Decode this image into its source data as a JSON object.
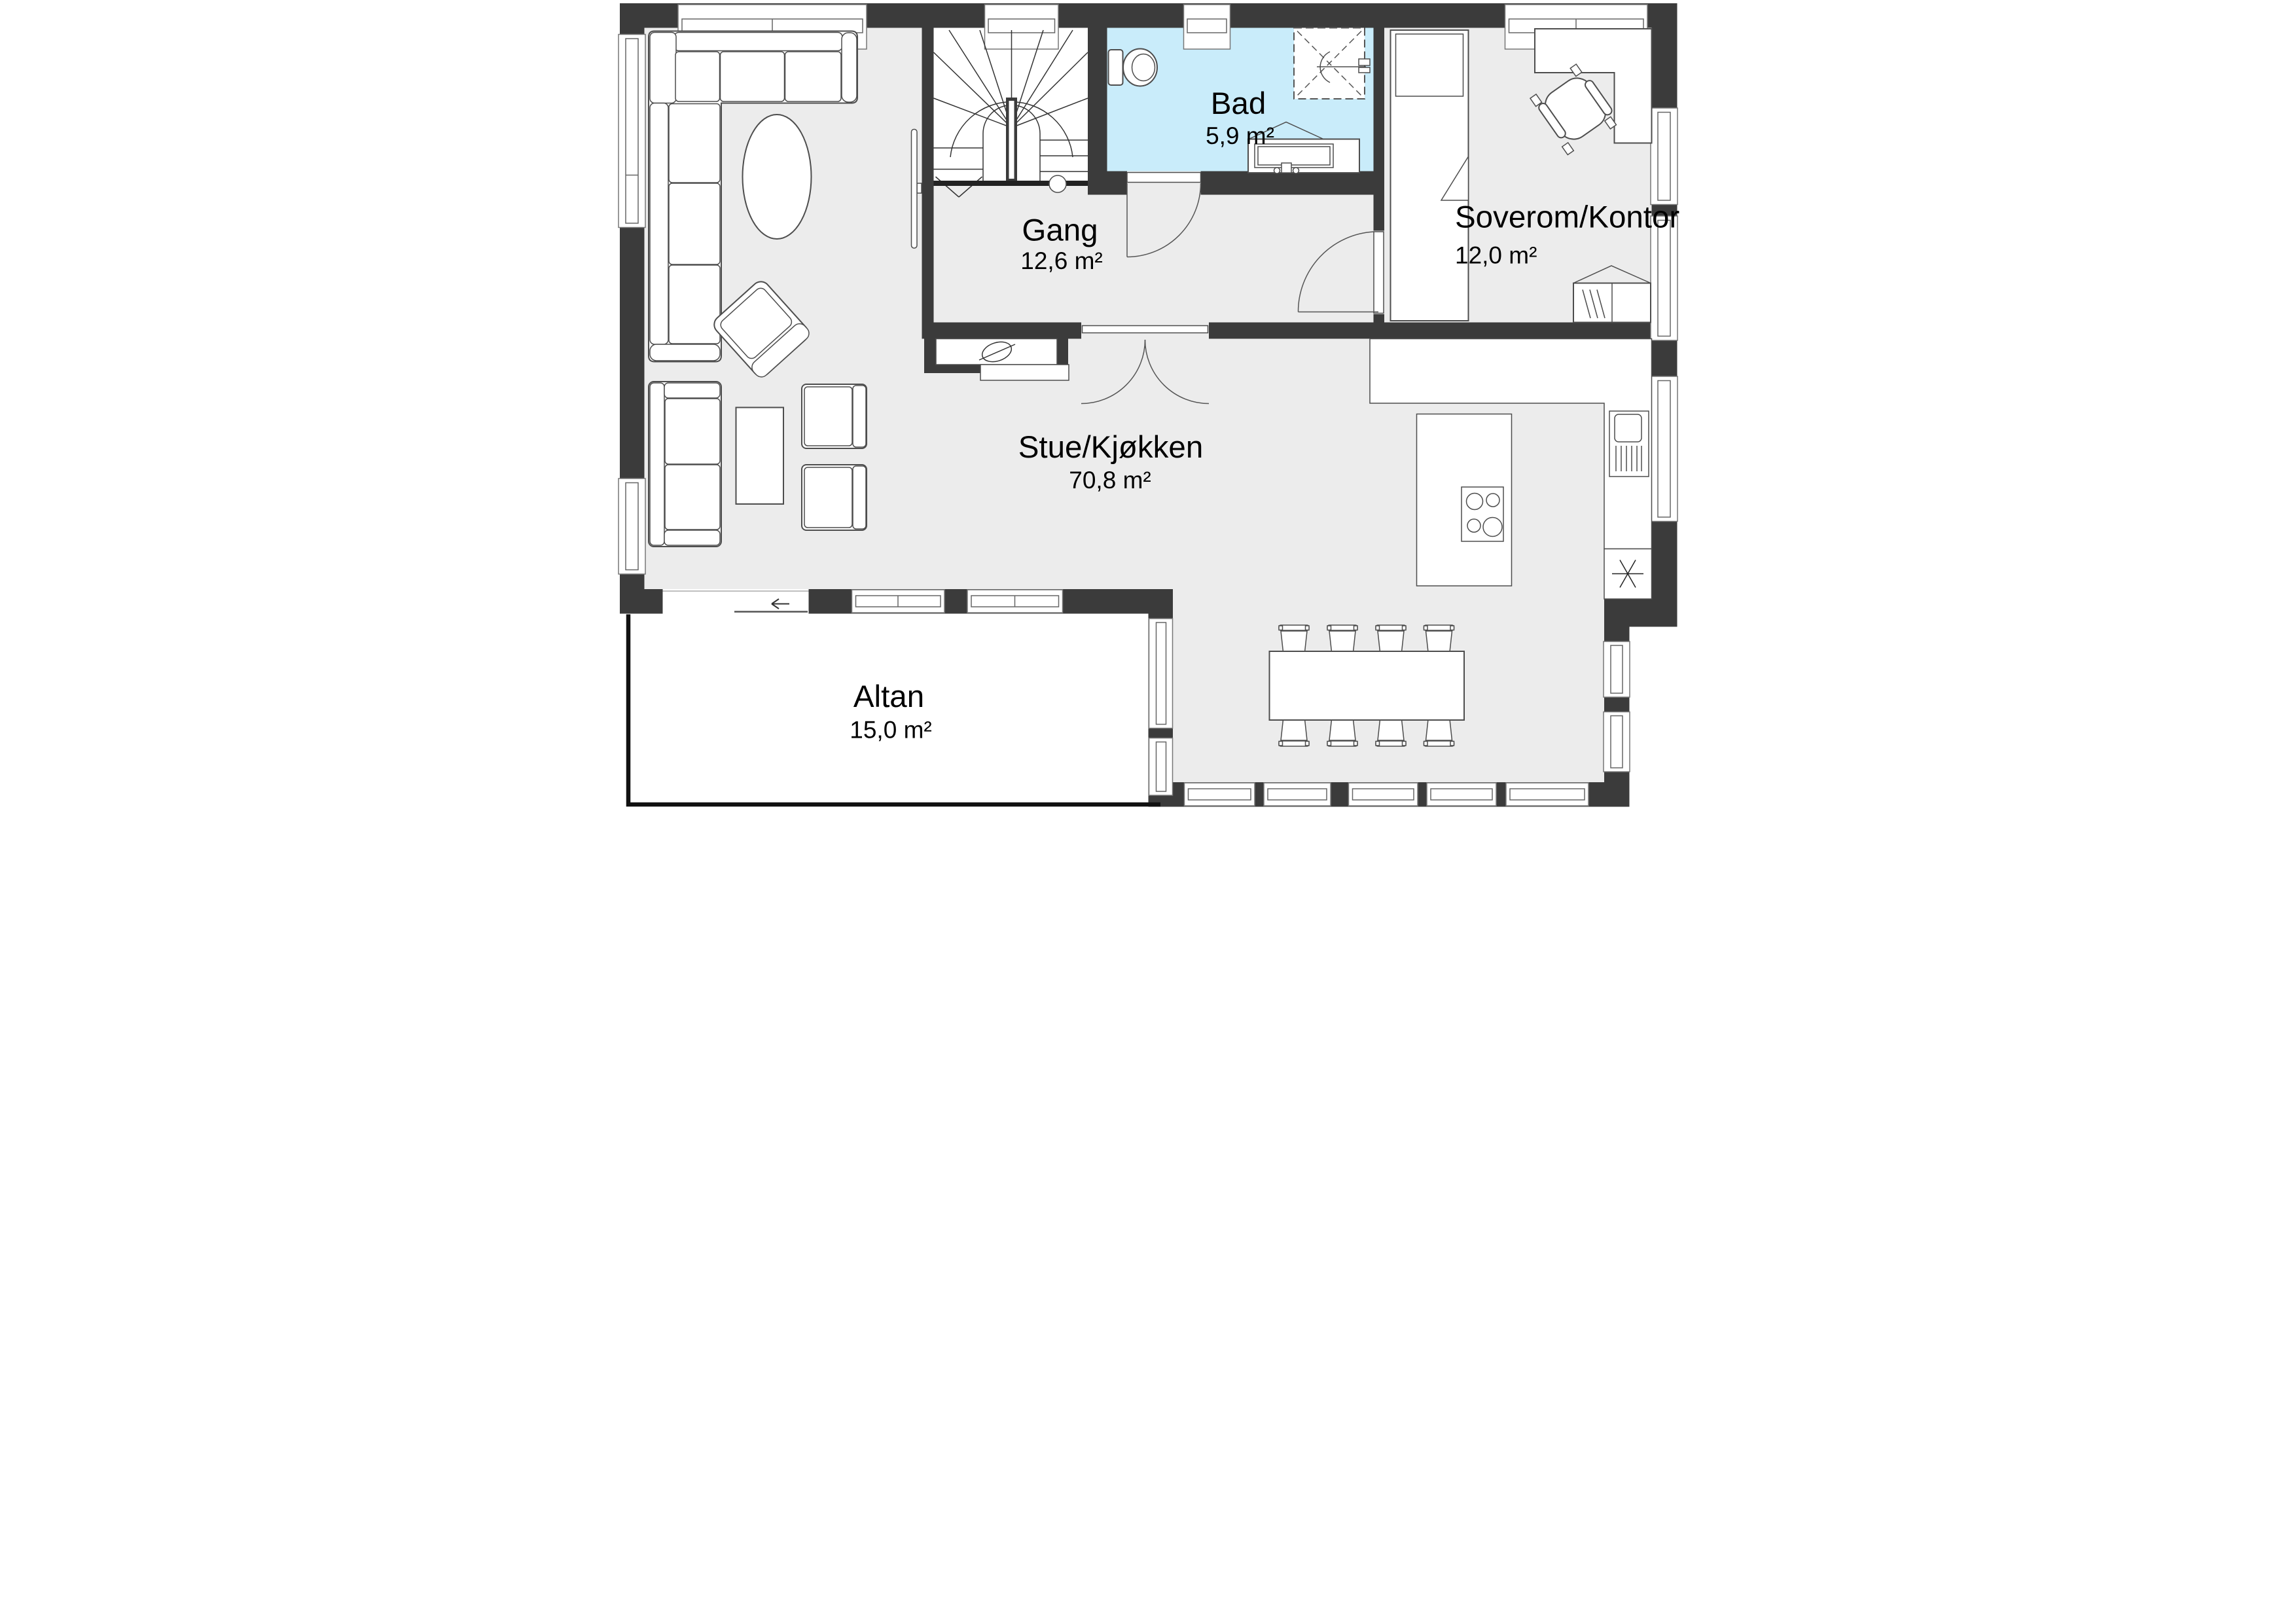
{
  "plan_title": "Floor plan",
  "colors": {
    "wall": "#3b3b3b",
    "floor": "#ececec",
    "bathroom_floor": "#c9ecfa",
    "outline": "#4d4d4d"
  },
  "rooms": [
    {
      "id": "stue",
      "name": "Stue/Kjøkken",
      "area": "70,8 m²"
    },
    {
      "id": "gang",
      "name": "Gang",
      "area": "12,6 m²"
    },
    {
      "id": "bad",
      "name": "Bad",
      "area": "5,9 m²"
    },
    {
      "id": "soverom",
      "name": "Soverom/Kontor",
      "area": "12,0 m²"
    },
    {
      "id": "altan",
      "name": "Altan",
      "area": "15,0 m²"
    }
  ]
}
